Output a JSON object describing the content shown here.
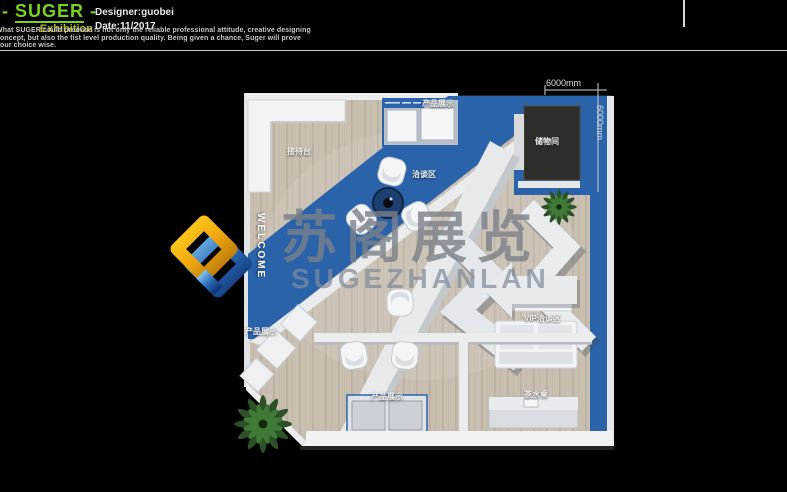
{
  "header": {
    "logo_dash": "-",
    "logo_name": "SUGER",
    "logo_sub": "Exhibition",
    "designer": "Designer:guobei",
    "date": "Date:11/2017",
    "tagline": "What SUGER could promise is not only the reliable professional attitude, creative designing concept, but also the fist level production quality. Being given a chance, Suger will prove your choice wise."
  },
  "plan": {
    "labels": {
      "reception": "接待台",
      "display_top": "产品展示",
      "storage": "储物间",
      "meeting": "洽谈区",
      "welcome": "WELCOME",
      "display_left": "产品展示",
      "vip": "VIP洽谈区",
      "display_bottom": "产品展示",
      "tea": "茶水桌"
    },
    "dimensions": {
      "width": "6000mm",
      "depth": "6000mm"
    }
  },
  "watermark": {
    "cn": "苏阁展览",
    "en": "SUGEZHANLAN"
  },
  "colors": {
    "accent_green": "#79d41f",
    "accent_yellow": "#b9bd2a",
    "booth_blue": "#2b63aa",
    "floor_wood": "#c9bfb1",
    "background": "#000000"
  }
}
